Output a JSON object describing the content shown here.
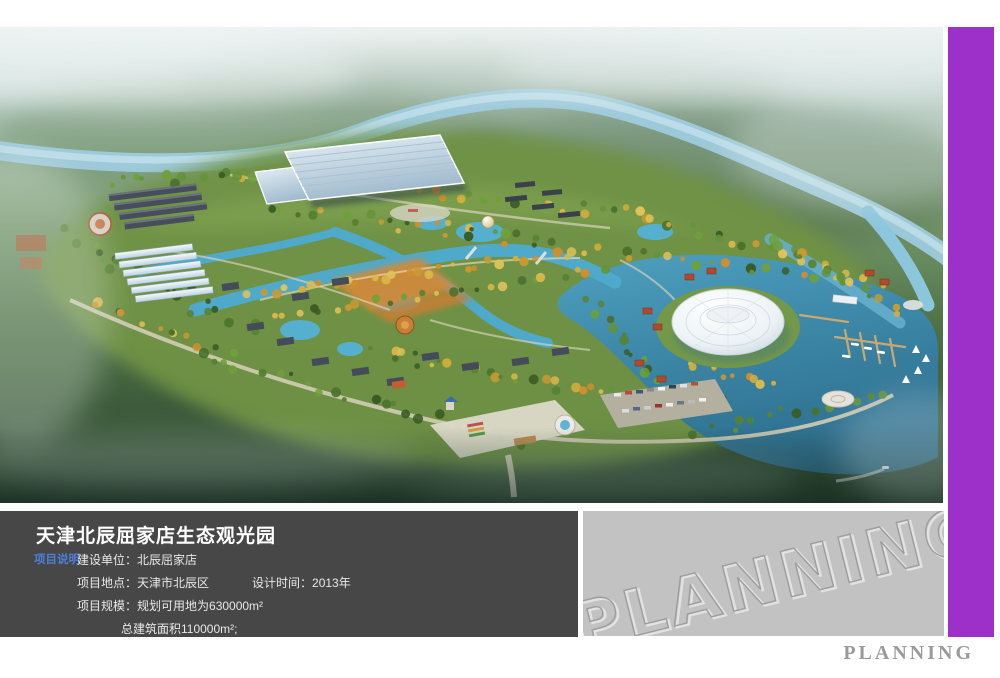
{
  "info_panel": {
    "title": "天津北辰屈家店生态观光园",
    "section_label": "项目说明",
    "rows": {
      "builder": {
        "label": "建设单位：",
        "value": "北辰屈家店"
      },
      "location": {
        "label": "项目地点：",
        "value": "天津市北辰区"
      },
      "design_time": {
        "label": "设计时间：",
        "value": "2013年"
      },
      "scale": {
        "label": "项目规模：",
        "value": "规划可用地为630000m²"
      },
      "scale2": {
        "value": "总建筑面积110000m²;"
      }
    }
  },
  "watermark_panel": {
    "text": "PLANNING"
  },
  "footer": {
    "text": "PLANNING"
  },
  "colors": {
    "accent_purple": "#9c30c8",
    "panel_dark": "#474747",
    "section_label_blue": "#4d7fd9",
    "watermark_gray": "#c2c2c2",
    "footer_text_gray": "#9a9a9a",
    "lake_teal": "#3a84a4",
    "park_green": "#6f9345"
  }
}
